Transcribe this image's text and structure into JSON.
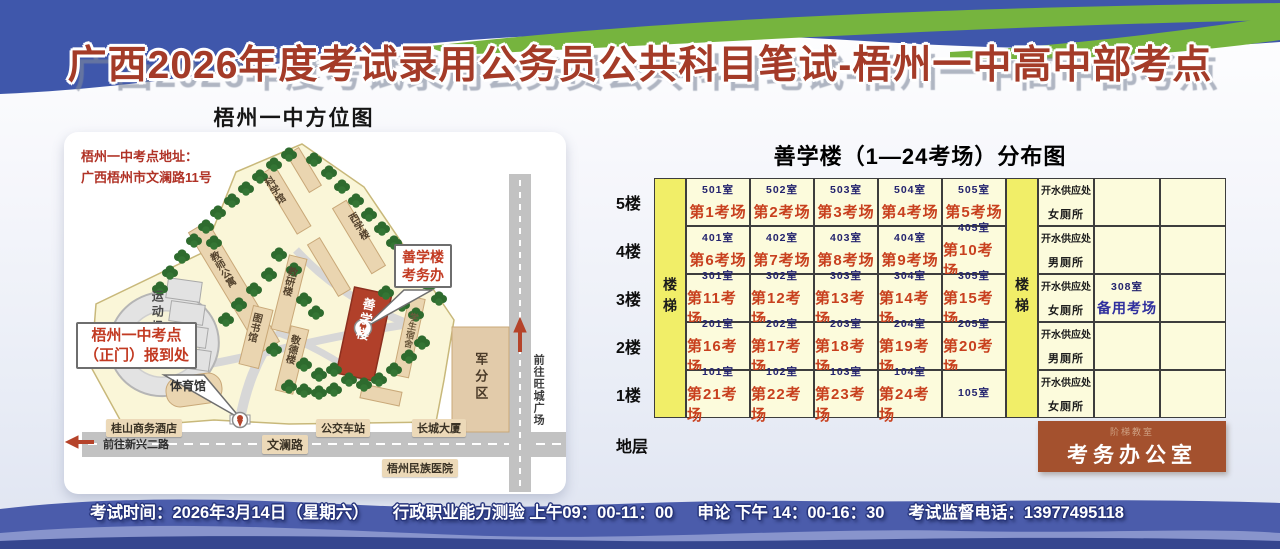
{
  "banner": {
    "title": "广西2026年度考试录用公务员公共科目笔试-梧州一中高中部考点"
  },
  "map": {
    "title": "梧州一中方位图",
    "address_line1": "梧州一中考点地址：",
    "address_line2": "广西梧州市文澜路11号",
    "callouts": {
      "gate_line1": "梧州一中考点",
      "gate_line2": "（正门）报到处",
      "building_line1": "善学楼",
      "building_line2": "考务办"
    },
    "labels": {
      "sports_field": "运动场",
      "science_hall": "科学馆",
      "teacher_apartments": "教师公寓",
      "west_study_building": "西学楼",
      "research_building": "教研楼",
      "library": "图书馆",
      "jingde_building": "敬德楼",
      "gymnasium": "体育馆",
      "shanxue_building": "善学楼",
      "student_dorm": "学生宿舍",
      "military_district": "军分区",
      "bus_station": "公交车站",
      "changcheng_tower": "长城大厦",
      "guishan_hotel": "桂山商务酒店",
      "minzu_hospital": "梧州民族医院",
      "wenlan_road": "文澜路",
      "to_xinxing_road": "前往新兴二路",
      "to_wangcheng_square": "前往旺城广场"
    }
  },
  "table": {
    "title": "善学楼（1—24考场）分布图",
    "stair_label": "楼梯",
    "floors": [
      {
        "label": "5楼",
        "water": "开水供应处",
        "toilet": "女厕所",
        "spare_room": "",
        "spare_hall": "",
        "rooms": [
          {
            "room": "501室",
            "hall": "第1考场"
          },
          {
            "room": "502室",
            "hall": "第2考场"
          },
          {
            "room": "503室",
            "hall": "第3考场"
          },
          {
            "room": "504室",
            "hall": "第4考场"
          },
          {
            "room": "505室",
            "hall": "第5考场"
          }
        ]
      },
      {
        "label": "4楼",
        "water": "开水供应处",
        "toilet": "男厕所",
        "spare_room": "",
        "spare_hall": "",
        "rooms": [
          {
            "room": "401室",
            "hall": "第6考场"
          },
          {
            "room": "402室",
            "hall": "第7考场"
          },
          {
            "room": "403室",
            "hall": "第8考场"
          },
          {
            "room": "404室",
            "hall": "第9考场"
          },
          {
            "room": "405室",
            "hall": "第10考场"
          }
        ]
      },
      {
        "label": "3楼",
        "water": "开水供应处",
        "toilet": "女厕所",
        "spare_room": "308室",
        "spare_hall": "备用考场",
        "rooms": [
          {
            "room": "301室",
            "hall": "第11考场"
          },
          {
            "room": "302室",
            "hall": "第12考场"
          },
          {
            "room": "303室",
            "hall": "第13考场"
          },
          {
            "room": "304室",
            "hall": "第14考场"
          },
          {
            "room": "305室",
            "hall": "第15考场"
          }
        ]
      },
      {
        "label": "2楼",
        "water": "开水供应处",
        "toilet": "男厕所",
        "spare_room": "",
        "spare_hall": "",
        "rooms": [
          {
            "room": "201室",
            "hall": "第16考场"
          },
          {
            "room": "202室",
            "hall": "第17考场"
          },
          {
            "room": "203室",
            "hall": "第18考场"
          },
          {
            "room": "204室",
            "hall": "第19考场"
          },
          {
            "room": "205室",
            "hall": "第20考场"
          }
        ]
      },
      {
        "label": "1楼",
        "water": "开水供应处",
        "toilet": "女厕所",
        "spare_room": "",
        "spare_hall": "",
        "rooms": [
          {
            "room": "101室",
            "hall": "第21考场"
          },
          {
            "room": "102室",
            "hall": "第22考场"
          },
          {
            "room": "103室",
            "hall": "第23考场"
          },
          {
            "room": "104室",
            "hall": "第24考场"
          },
          {
            "room": "105室",
            "hall": ""
          }
        ]
      }
    ],
    "ground": {
      "label": "地层",
      "office_small": "阶梯教室",
      "office": "考务办公室"
    }
  },
  "footer": {
    "exam_time": "考试时间：2026年3月14日（星期六）",
    "subject_morning": "行政职业能力测验 上午09：00-11：00",
    "subject_afternoon": "申论 下午 14：00-16：30",
    "phone": "考试监督电话：13977495118"
  },
  "colors": {
    "banner_blue": "#3f57ab",
    "banner_green": "#76b43e",
    "title_red": "#a43b28",
    "table_cell_bg": "#fcfbdc",
    "stair_yellow": "#f1ee68",
    "exam_hall_red": "#c8401e",
    "room_no_navy": "#23236e",
    "spare_blue": "#2f2f9e",
    "office_brown": "#a4512e",
    "building_red": "#b1402a",
    "footer_blue": "#4b5cab"
  }
}
